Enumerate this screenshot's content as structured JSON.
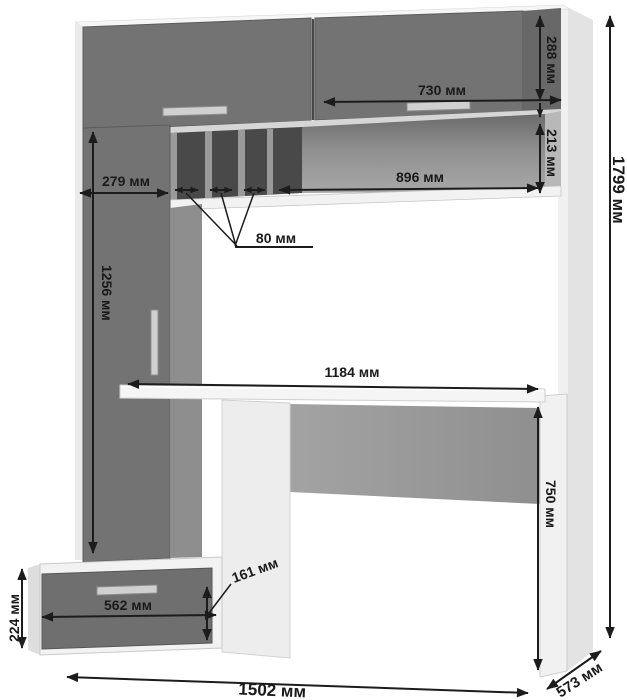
{
  "diagram": {
    "kind": "furniture-dimension-drawing",
    "subject": "computer-desk-with-hutch",
    "unit": "мм",
    "labels": {
      "top_door_height": "288 мм",
      "top_door_width": "730 мм",
      "niche_height": "213 мм",
      "niche_width": "896 мм",
      "left_column_width": "279 мм",
      "pigeonhole_width": "80 мм",
      "left_door_height": "1256 мм",
      "desktop_width": "1184 мм",
      "desk_clearance_height": "750 мм",
      "overall_height": "1799 мм",
      "pedestal_height": "224 мм",
      "drawer_width": "562 мм",
      "drawer_front_height": "161 мм",
      "overall_width": "1502 мм",
      "overall_depth": "573 мм"
    },
    "colors": {
      "front_panels": "#737373",
      "front_panels_shadow": "#686868",
      "drawer_front": "#6f6f6f",
      "carcass": "#f3f3f3",
      "carcass_shade": "#e3e3e3",
      "pigeonhole_back": "#494949",
      "divider": "#9a9a9a",
      "column_side": "#8e8e8e",
      "handle": "#d0d0d0",
      "dimension_ink": "#1c1c1c",
      "background": "#ffffff"
    }
  }
}
